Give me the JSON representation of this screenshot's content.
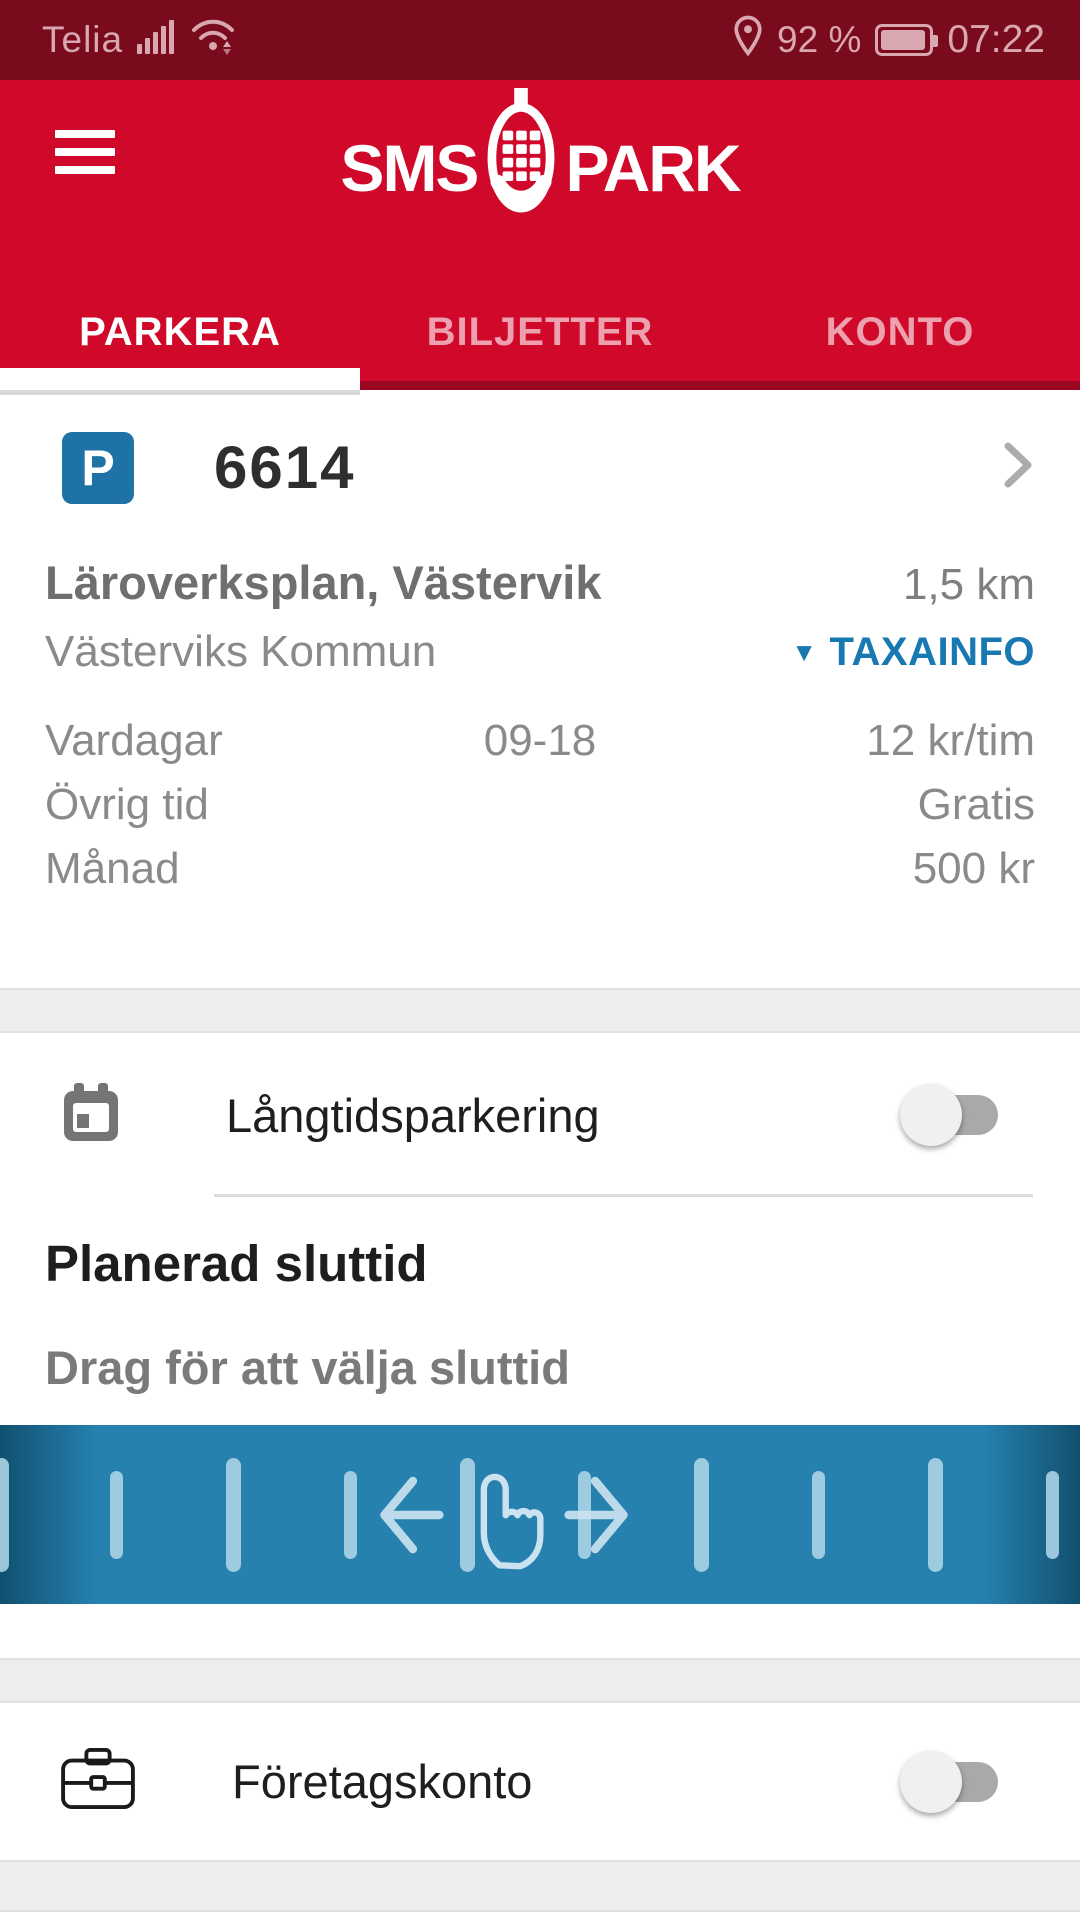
{
  "status_bar": {
    "carrier": "Telia",
    "battery_pct": "92 %",
    "time": "07:22",
    "icons": [
      "signal-strength-icon",
      "wifi-icon",
      "location-pin-icon",
      "battery-icon"
    ]
  },
  "header": {
    "logo_left": "SMS",
    "logo_right": "PARK",
    "logo_icon": "phone-keypad-icon",
    "menu_icon": "hamburger-icon"
  },
  "tabs": [
    {
      "label": "PARKERA",
      "active": true
    },
    {
      "label": "BILJETTER",
      "active": false
    },
    {
      "label": "KONTO",
      "active": false
    }
  ],
  "station": {
    "badge": "P",
    "code": "6614",
    "name": "Läroverksplan, Västervik",
    "distance": "1,5 km",
    "operator": "Västerviks Kommun",
    "taxa_link": "TAXAINFO",
    "taxa_arrow": "▼",
    "rates": [
      {
        "label": "Vardagar",
        "time": "09-18",
        "price": "12 kr/tim"
      },
      {
        "label": "Övrig tid",
        "time": "",
        "price": "Gratis"
      },
      {
        "label": "Månad",
        "time": "",
        "price": "500 kr"
      }
    ]
  },
  "longterm": {
    "label": "Långtidsparkering",
    "enabled": false,
    "icon": "calendar-icon",
    "heading": "Planerad sluttid",
    "subheading": "Drag för att välja sluttid",
    "slider_icons": [
      "arrow-left-icon",
      "drag-hand-icon",
      "arrow-right-icon"
    ]
  },
  "business": {
    "label": "Företagskonto",
    "enabled": false,
    "icon": "briefcase-icon"
  },
  "colors": {
    "statusbar_red": "#7A0B1D",
    "brand_red": "#D0092B",
    "badge_blue": "#1E72A6",
    "link_blue": "#1878B2",
    "ruler_blue": "#2681AF"
  }
}
